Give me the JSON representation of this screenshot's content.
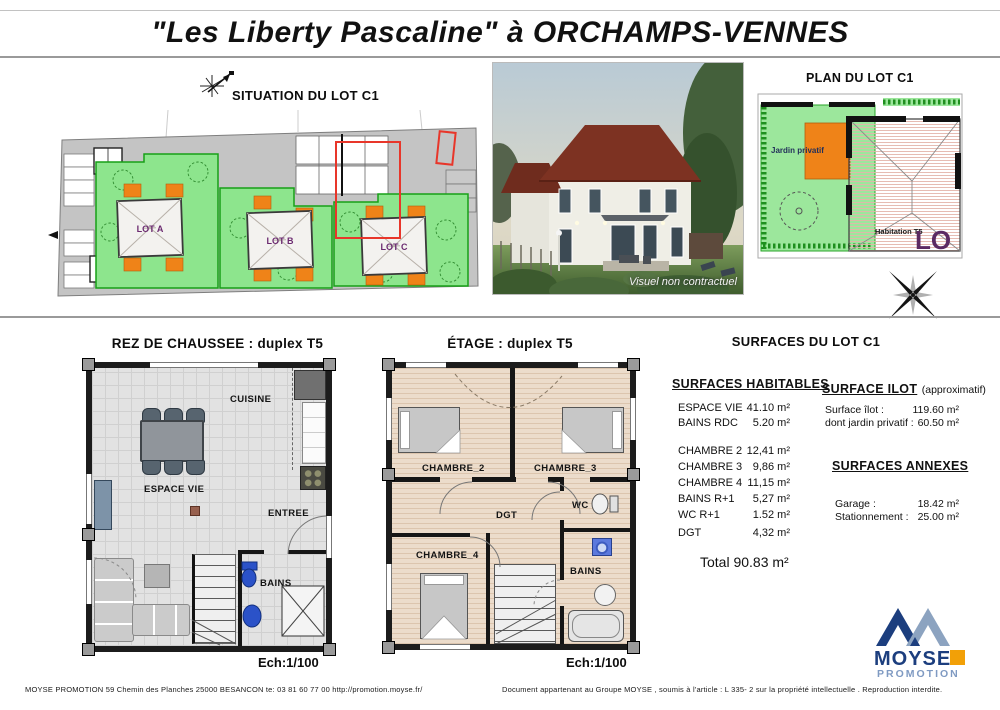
{
  "page": {
    "title": "\"Les Liberty Pascaline\" à ORCHAMPS-VENNES"
  },
  "situation": {
    "title": "SITUATION DU LOT C1",
    "lot_a": "LOT A",
    "lot_b": "LOT B",
    "lot_c": "LOT C"
  },
  "photo": {
    "caption": "Visuel non contractuel"
  },
  "plan_lot": {
    "title": "PLAN DU LOT C1",
    "jardin": "Jardin privatif",
    "habitation": "Habitation T5",
    "corner": "LO"
  },
  "rdc": {
    "title": "REZ DE CHAUSSEE : duplex T5",
    "cuisine": "CUISINE",
    "espace_vie": "ESPACE VIE",
    "entree": "ENTREE",
    "bains": "BAINS",
    "scale": "Ech:1/100"
  },
  "etage": {
    "title": "ÉTAGE : duplex T5",
    "chambre2": "CHAMBRE_2",
    "chambre3": "CHAMBRE_3",
    "chambre4": "CHAMBRE_4",
    "dgt": "DGT",
    "wc": "WC",
    "bains": "BAINS",
    "scale": "Ech:1/100"
  },
  "surfaces": {
    "title": "SURFACES DU LOT C1",
    "habitables_heading": "SURFACES HABITABLES",
    "habitables_rows": [
      {
        "label": "ESPACE VIE",
        "value": "41.10 m²"
      },
      {
        "label": "BAINS RDC",
        "value": "5.20 m²"
      },
      {
        "label": "CHAMBRE 2",
        "value": "12,41 m²"
      },
      {
        "label": "CHAMBRE 3",
        "value": "9,86 m²"
      },
      {
        "label": "CHAMBRE 4",
        "value": "11,15 m²"
      },
      {
        "label": "BAINS R+1",
        "value": "5,27 m²"
      },
      {
        "label": "WC R+1",
        "value": "1.52 m²"
      },
      {
        "label": "DGT",
        "value": "4,32 m²"
      }
    ],
    "total": "Total 90.83 m²",
    "ilot_heading": "SURFACE ILOT",
    "ilot_note": "(approximatif)",
    "ilot_rows": [
      {
        "label": "Surface îlot :",
        "value": "119.60 m²"
      },
      {
        "label": "dont jardin privatif :",
        "value": "60.50 m²"
      }
    ],
    "annexes_heading": "SURFACES ANNEXES",
    "annexes_rows": [
      {
        "label": "Garage :",
        "value": "18.42 m²"
      },
      {
        "label": "Stationnement :",
        "value": "25.00 m²"
      }
    ]
  },
  "logo": {
    "name": "MOYSE",
    "subtitle": "PROMOTION"
  },
  "footer": {
    "left": "MOYSE  PROMOTION   59  Chemin  des  Planches  25000   BESANCON    te: 03 81 60 77 00    http://promotion.moyse.fr/",
    "right": "Document appartenant au Groupe MOYSE , soumis à l'article : L 335- 2 sur la propriété intellectuelle . Reproduction interdite."
  },
  "colors": {
    "garden_green": "#8de58d",
    "terrace_orange": "#ef8318",
    "highlight_red": "#e8362a",
    "lot_label_purple": "#6b2a70",
    "wall_dark": "#1c1c1c",
    "logo_navy": "#1c3e7e",
    "logo_steel": "#8ca3c0",
    "logo_orange": "#f2a007"
  }
}
